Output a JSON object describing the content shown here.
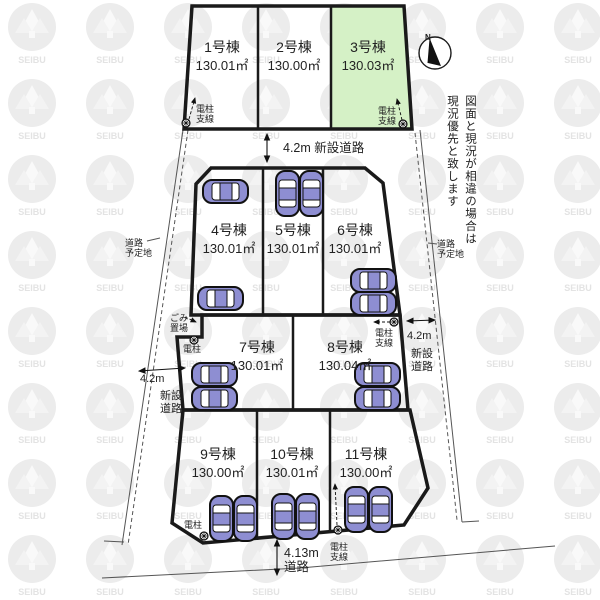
{
  "lots": [
    {
      "name": "1号棟",
      "area": "130.01㎡"
    },
    {
      "name": "2号棟",
      "area": "130.00㎡"
    },
    {
      "name": "3号棟",
      "area": "130.03㎡"
    },
    {
      "name": "4号棟",
      "area": "130.01㎡"
    },
    {
      "name": "5号棟",
      "area": "130.01㎡"
    },
    {
      "name": "6号棟",
      "area": "130.01㎡"
    },
    {
      "name": "7号棟",
      "area": "130.01㎡"
    },
    {
      "name": "8号棟",
      "area": "130.04㎡"
    },
    {
      "name": "9号棟",
      "area": "130.00㎡"
    },
    {
      "name": "10号棟",
      "area": "130.01㎡"
    },
    {
      "name": "11号棟",
      "area": "130.00㎡"
    }
  ],
  "roads": {
    "top": "4.2m 新設道路",
    "left": {
      "width": "4.2m",
      "name1": "新設",
      "name2": "道路"
    },
    "right": {
      "width": "4.2m",
      "name1": "新設",
      "name2": "道路"
    },
    "bottom": {
      "width": "4.13m",
      "name": "道路"
    },
    "planned": {
      "line1": "道路",
      "line2": "予定地"
    }
  },
  "labels": {
    "pole": "電柱",
    "brace": "支線",
    "garbage1": "ごみ",
    "garbage2": "置場"
  },
  "compass": {
    "n": "N"
  },
  "notice": {
    "line1": "図面と現況が相違の場合は",
    "line2": "現況優先と致します"
  },
  "watermark": {
    "text": "SEIBU"
  },
  "colors": {
    "highlight": "#d5f1c6",
    "car_body": "#8e8ed2",
    "line": "#1a1a1a"
  }
}
